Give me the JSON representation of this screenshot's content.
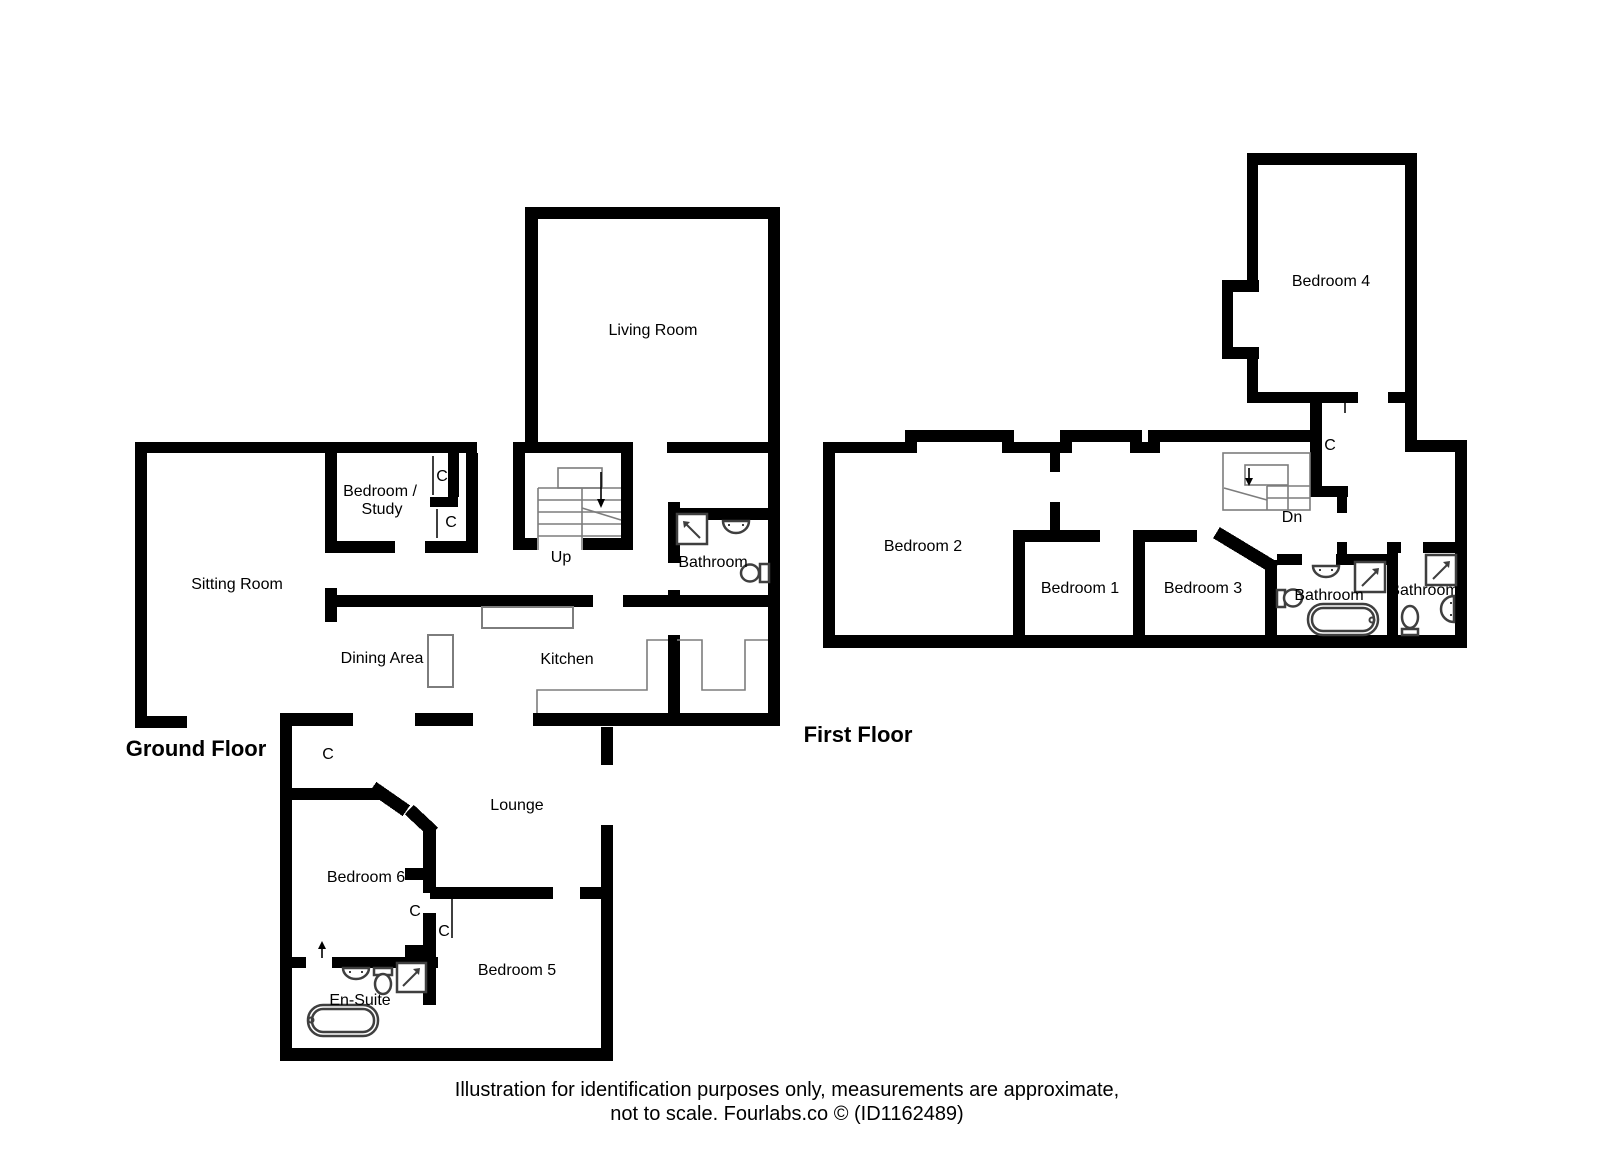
{
  "ground_floor": {
    "title": "Ground Floor",
    "labels": {
      "living_room": "Living Room",
      "sitting_room": "Sitting Room",
      "bedroom_study_line1": "Bedroom /",
      "bedroom_study_line2": "Study",
      "dining_area": "Dining Area",
      "kitchen": "Kitchen",
      "bathroom": "Bathroom",
      "lounge": "Lounge",
      "bedroom_6": "Bedroom 6",
      "bedroom_5": "Bedroom 5",
      "en_suite": "En-Suite",
      "stairs_up": "Up"
    }
  },
  "first_floor": {
    "title": "First Floor",
    "labels": {
      "bedroom_4": "Bedroom 4",
      "bedroom_2": "Bedroom 2",
      "bedroom_1": "Bedroom 1",
      "bedroom_3": "Bedroom 3",
      "bathroom_main": "Bathroom",
      "bathroom_second": "Bathroom",
      "stairs_dn": "Dn"
    }
  },
  "closet_label": "C",
  "footer": {
    "line1": "Illustration for identification purposes only, measurements are approximate,",
    "line2": "not to scale. Fourlabs.co © (ID1162489)"
  },
  "colors": {
    "wall": "#000000",
    "background": "#ffffff",
    "fixture_outline": "#3f3f3f"
  }
}
